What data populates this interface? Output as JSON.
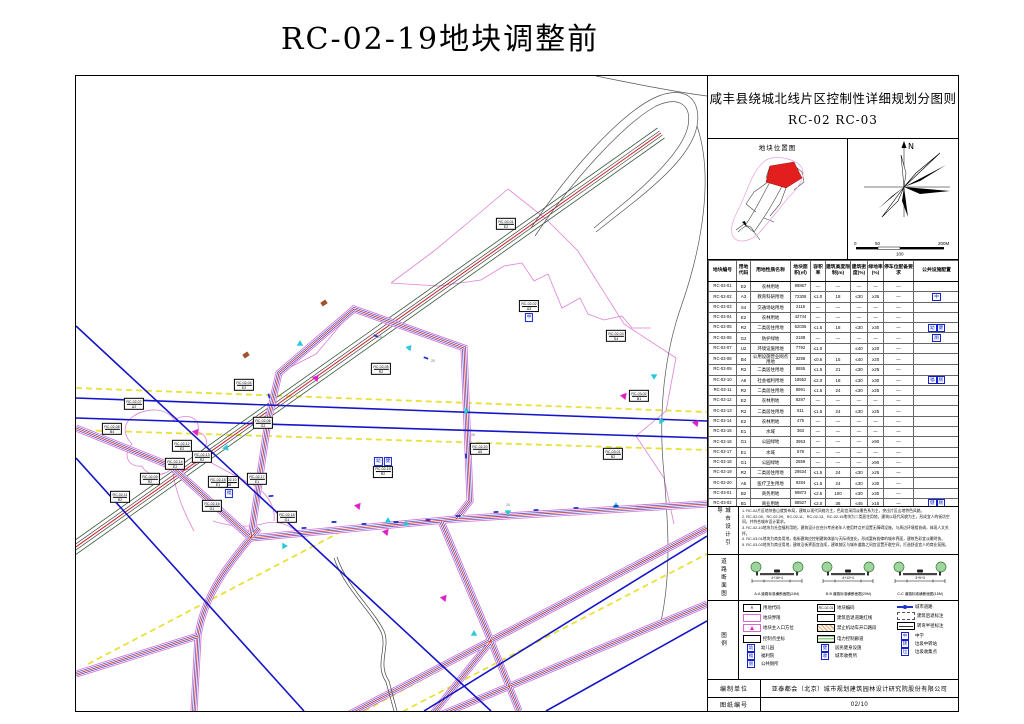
{
  "page_title": "RC-02-19地块调整前",
  "panel": {
    "title_line1": "咸丰县绕城北线片区控制性详细规划分图则",
    "title_line2": "RC-02 RC-03",
    "location_map_title": "地块位置图",
    "compass_label": "N",
    "scale_ticks": [
      "0",
      "50",
      "100",
      "200M"
    ],
    "table": {
      "headers": [
        "地块编号",
        "用地代码",
        "用地性质名称",
        "地块面积(㎡)",
        "容积率",
        "建筑高度限制(m)",
        "建筑密度(%)",
        "绿地率(%)",
        "停车位配备要求",
        "公共设施配置"
      ],
      "rows": [
        {
          "no": "RC-02-01",
          "code": "E2",
          "name": "农林用地",
          "area": "98867",
          "far": "—",
          "height": "—",
          "density": "—",
          "green": "—",
          "parking": "—",
          "facilities": []
        },
        {
          "no": "RC-02-02",
          "code": "A3",
          "name": "教育科研用地",
          "area": "72308",
          "far": "≤1.0",
          "height": "18",
          "density": "≤30",
          "green": "≥35",
          "parking": "—",
          "facilities": [
            "中"
          ]
        },
        {
          "no": "RC-02-03",
          "code": "S4",
          "name": "交通场站用地",
          "area": "2118",
          "far": "—",
          "height": "—",
          "density": "—",
          "green": "—",
          "parking": "—",
          "facilities": []
        },
        {
          "no": "RC-02-04",
          "code": "E2",
          "name": "农林用地",
          "area": "42744",
          "far": "—",
          "height": "—",
          "density": "—",
          "green": "—",
          "parking": "—",
          "facilities": []
        },
        {
          "no": "RC-02-05",
          "code": "R2",
          "name": "二类居住用地",
          "area": "62035",
          "far": "≤1.5",
          "height": "18",
          "density": "≤30",
          "green": "≥30",
          "parking": "—",
          "facilities": [
            "幼",
            "健"
          ]
        },
        {
          "no": "RC-02-06",
          "code": "G2",
          "name": "防护绿地",
          "area": "2188",
          "far": "—",
          "height": "—",
          "density": "—",
          "green": "—",
          "parking": "—",
          "facilities": [
            "厕"
          ]
        },
        {
          "no": "RC-02-07",
          "code": "U2",
          "name": "环境设施用地",
          "area": "7792",
          "far": "≤1.0",
          "height": "",
          "density": "≤40",
          "green": "≥20",
          "parking": "—",
          "facilities": []
        },
        {
          "no": "RC-02-08",
          "code": "B4",
          "name": "公用设施营业网点用地",
          "area": "3298",
          "far": "≤0.6",
          "height": "15",
          "density": "≤40",
          "green": "≥20",
          "parking": "—",
          "facilities": []
        },
        {
          "no": "RC-02-09",
          "code": "R2",
          "name": "二类居住用地",
          "area": "8655",
          "far": "≤1.5",
          "height": "21",
          "density": "≤30",
          "green": "≥25",
          "parking": "—",
          "facilities": []
        },
        {
          "no": "RC-02-10",
          "code": "A6",
          "name": "社会福利用地",
          "area": "18552",
          "far": "≤2.0",
          "height": "18",
          "density": "≤30",
          "green": "≥30",
          "parking": "—",
          "facilities": [
            "福",
            "厕"
          ]
        },
        {
          "no": "RC-02-11",
          "code": "R2",
          "name": "二类居住用地",
          "area": "8991",
          "far": "≤1.5",
          "height": "24",
          "density": "≤30",
          "green": "≥25",
          "parking": "—",
          "facilities": []
        },
        {
          "no": "RC-02-12",
          "code": "E2",
          "name": "农林用地",
          "area": "8297",
          "far": "—",
          "height": "—",
          "density": "—",
          "green": "—",
          "parking": "—",
          "facilities": []
        },
        {
          "no": "RC-02-13",
          "code": "R2",
          "name": "二类居住用地",
          "area": "811",
          "far": "≤1.5",
          "height": "24",
          "density": "≤30",
          "green": "≥25",
          "parking": "—",
          "facilities": []
        },
        {
          "no": "RC-02-14",
          "code": "E2",
          "name": "农林用地",
          "area": "475",
          "far": "—",
          "height": "—",
          "density": "—",
          "green": "—",
          "parking": "—",
          "facilities": []
        },
        {
          "no": "RC-02-15",
          "code": "E1",
          "name": "水域",
          "area": "363",
          "far": "—",
          "height": "—",
          "density": "—",
          "green": "—",
          "parking": "—",
          "facilities": []
        },
        {
          "no": "RC-02-16",
          "code": "G1",
          "name": "公园绿地",
          "area": "3953",
          "far": "—",
          "height": "—",
          "density": "—",
          "green": "≥90",
          "parking": "—",
          "facilities": []
        },
        {
          "no": "RC-02-17",
          "code": "E1",
          "name": "水域",
          "area": "578",
          "far": "—",
          "height": "—",
          "density": "—",
          "green": "—",
          "parking": "—",
          "facilities": []
        },
        {
          "no": "RC-02-18",
          "code": "G1",
          "name": "公园绿地",
          "area": "2559",
          "far": "—",
          "height": "—",
          "density": "—",
          "green": "≥90",
          "parking": "—",
          "facilities": []
        },
        {
          "no": "RC-02-19",
          "code": "R2",
          "name": "二类居住用地",
          "area": "29534",
          "far": "≤1.5",
          "height": "24",
          "density": "≤30",
          "green": "≥25",
          "parking": "—",
          "facilities": []
        },
        {
          "no": "RC-02-20",
          "code": "A5",
          "name": "医疗卫生用地",
          "area": "9284",
          "far": "≤1.5",
          "height": "24",
          "density": "≤30",
          "green": "≥30",
          "parking": "—",
          "facilities": []
        },
        {
          "no": "RC-03-01",
          "code": "B2",
          "name": "商务用地",
          "area": "99873",
          "far": "≤2.5",
          "height": "100",
          "density": "≤30",
          "green": "≥30",
          "parking": "—",
          "facilities": []
        },
        {
          "no": "RC-03-02",
          "code": "B1",
          "name": "商业用地",
          "area": "88527",
          "far": "≤2.0",
          "height": "36",
          "density": "≤45",
          "green": "≥15",
          "parking": "—",
          "facilities": [
            "健",
            "厕"
          ]
        }
      ]
    },
    "notes_label": "城市设计引导",
    "notes": [
      "1. RC-02片区地块依山就势布局，建筑以现代风格为主，色彩宜采用淡雅色系为主，突出片区山地特色风貌。",
      "2. RC-02-05、RC-02-09、RC-02-11、RC-02-13、RC-02-19地块为二类居住用地，建筑以现代风貌为主，形成宜人的街坊空间，并符合城市设计要求。",
      "3. RC-02-10地块为社会福利用地，建筑设计应充分考虑老年人使用特点并设置无障碍设施，与周边环境相协调，体现人文关怀。",
      "4. RC-03-01地块为商务用地，临街建筑应控制建筑体量与天际线变化，形成富有韵律的城市界面，建筑色彩宜淡雅明快。",
      "5. RC-03-02地块为商业用地，建筑沿街界面宜连续，建筑前区与城市道路之间宜设置开敞空间，打造舒适宜人的商业氛围。"
    ],
    "sections_label": "道路断面图",
    "sections": [
      {
        "dims": "4+16+4",
        "caption": "A-A 道路标准横断面图(24M)"
      },
      {
        "dims": "4+12+4",
        "caption": "B-B 道路标准横断面图(20M)"
      },
      {
        "dims": "3+9+3",
        "caption": "C-C 道路标准横断面图(15M)"
      }
    ],
    "legend_label": "图例",
    "legend": {
      "col1": [
        {
          "type": "codebox",
          "sym": "R",
          "label": "用地代码"
        },
        {
          "type": "pinkrect",
          "label": "地块界限"
        },
        {
          "type": "entry",
          "label": "地块主入口方位"
        },
        {
          "type": "whiterect",
          "label": "控制点坐标"
        },
        {
          "type": "chip",
          "sym": "幼",
          "label": "幼儿园"
        },
        {
          "type": "chip",
          "sym": "福",
          "label": "福利院"
        },
        {
          "type": "chip",
          "sym": "厕",
          "label": "公共厕所"
        }
      ],
      "col2": [
        {
          "type": "codebox",
          "sym": "RC-02-01",
          "label": "地块编码"
        },
        {
          "type": "whiterect",
          "label": "建筑后退道路红线"
        },
        {
          "type": "hatch-o",
          "label": "禁止机动车开口路段"
        },
        {
          "type": "hatch-g",
          "label": "电力控制廊道"
        },
        {
          "type": "chip",
          "sym": "健",
          "label": "居民健身设施"
        },
        {
          "type": "chip",
          "sym": "收",
          "label": "城市收费所"
        }
      ],
      "col3": [
        {
          "type": "road",
          "label": "城市道路"
        },
        {
          "type": "dash",
          "label": "建筑后退标注"
        },
        {
          "type": "tick",
          "label": "转弯半径标注"
        },
        {
          "type": "chip",
          "sym": "中",
          "label": "中学"
        },
        {
          "type": "chip",
          "sym": "转",
          "label": "垃圾中转站"
        },
        {
          "type": "chip",
          "sym": "垃",
          "label": "垃圾收集点"
        }
      ]
    },
    "credit_label": "编制单位",
    "credit_value": "亚泰都会（北京）城市规划建筑园林设计研究院股份有限公司",
    "sheet_no_label": "图纸编号",
    "sheet_no_value": "02/10"
  },
  "map": {
    "labels": [
      {
        "id": "RC-02-01",
        "code": "E2",
        "x": 430,
        "y": 148,
        "icons": [],
        "pos": "below"
      },
      {
        "id": "RC-02-02",
        "code": "A3",
        "x": 453,
        "y": 235,
        "icons": [
          "中"
        ],
        "pos": "below"
      },
      {
        "id": "RC-02-03",
        "code": "S4",
        "x": 540,
        "y": 260,
        "icons": [],
        "pos": "below"
      },
      {
        "id": "RC-02-04",
        "code": "E2",
        "x": 168,
        "y": 309,
        "icons": [],
        "pos": "below"
      },
      {
        "id": "RC-02-05",
        "code": "R2",
        "x": 305,
        "y": 293,
        "icons": [],
        "pos": "below"
      },
      {
        "id": "RC-02-06",
        "code": "G2",
        "x": 187,
        "y": 347,
        "icons": [],
        "pos": "below"
      },
      {
        "id": "RC-02-07",
        "code": "U2",
        "x": 58,
        "y": 328,
        "icons": [],
        "pos": "below"
      },
      {
        "id": "RC-02-08",
        "code": "B4",
        "x": 36,
        "y": 353,
        "icons": [],
        "pos": "below"
      },
      {
        "id": "RC-02-09",
        "code": "R2",
        "x": 74,
        "y": 403,
        "icons": [],
        "pos": "below"
      },
      {
        "id": "RC-02-10",
        "code": "A6",
        "x": 153,
        "y": 411,
        "icons": [
          "福"
        ],
        "pos": "below"
      },
      {
        "id": "RC-02-11",
        "code": "R2",
        "x": 44,
        "y": 421,
        "icons": [],
        "pos": "below"
      },
      {
        "id": "RC-02-12",
        "code": "E2",
        "x": 106,
        "y": 370,
        "icons": [],
        "pos": "below"
      },
      {
        "id": "RC-02-13",
        "code": "R2",
        "x": 126,
        "y": 381,
        "icons": [],
        "pos": "below"
      },
      {
        "id": "RC-02-14",
        "code": "E2",
        "x": 99,
        "y": 388,
        "icons": [],
        "pos": "below"
      },
      {
        "id": "RC-02-15",
        "code": "E1",
        "x": 142,
        "y": 406,
        "icons": [],
        "pos": "below"
      },
      {
        "id": "RC-02-16",
        "code": "G1",
        "x": 136,
        "y": 430,
        "icons": [],
        "pos": "below"
      },
      {
        "id": "RC-02-17",
        "code": "E1",
        "x": 181,
        "y": 403,
        "icons": [],
        "pos": "below"
      },
      {
        "id": "RC-02-18",
        "code": "G1",
        "x": 211,
        "y": 441,
        "icons": [],
        "pos": "below"
      },
      {
        "id": "RC-02-19",
        "code": "R2",
        "x": 307,
        "y": 391,
        "icons": [
          "幼",
          "健"
        ],
        "pos": "above"
      },
      {
        "id": "RC-02-20",
        "code": "A5",
        "x": 404,
        "y": 373,
        "icons": [],
        "pos": "below"
      },
      {
        "id": "RC-03-01",
        "code": "B2",
        "x": 537,
        "y": 378,
        "icons": [],
        "pos": "below"
      },
      {
        "id": "RC-03-02",
        "code": "B1",
        "x": 563,
        "y": 320,
        "icons": [],
        "pos": "below"
      }
    ]
  },
  "colors": {
    "road_edge_pink": "#d868cc",
    "road_blue": "#4444cc",
    "centerline_red": "#cc2222",
    "power_blue": "#1515c8",
    "yellow_dash": "#e8e13a",
    "entry_cyan": "#29c8d8",
    "entry_magenta": "#e021c9",
    "highlight_red": "#e31e1e"
  }
}
